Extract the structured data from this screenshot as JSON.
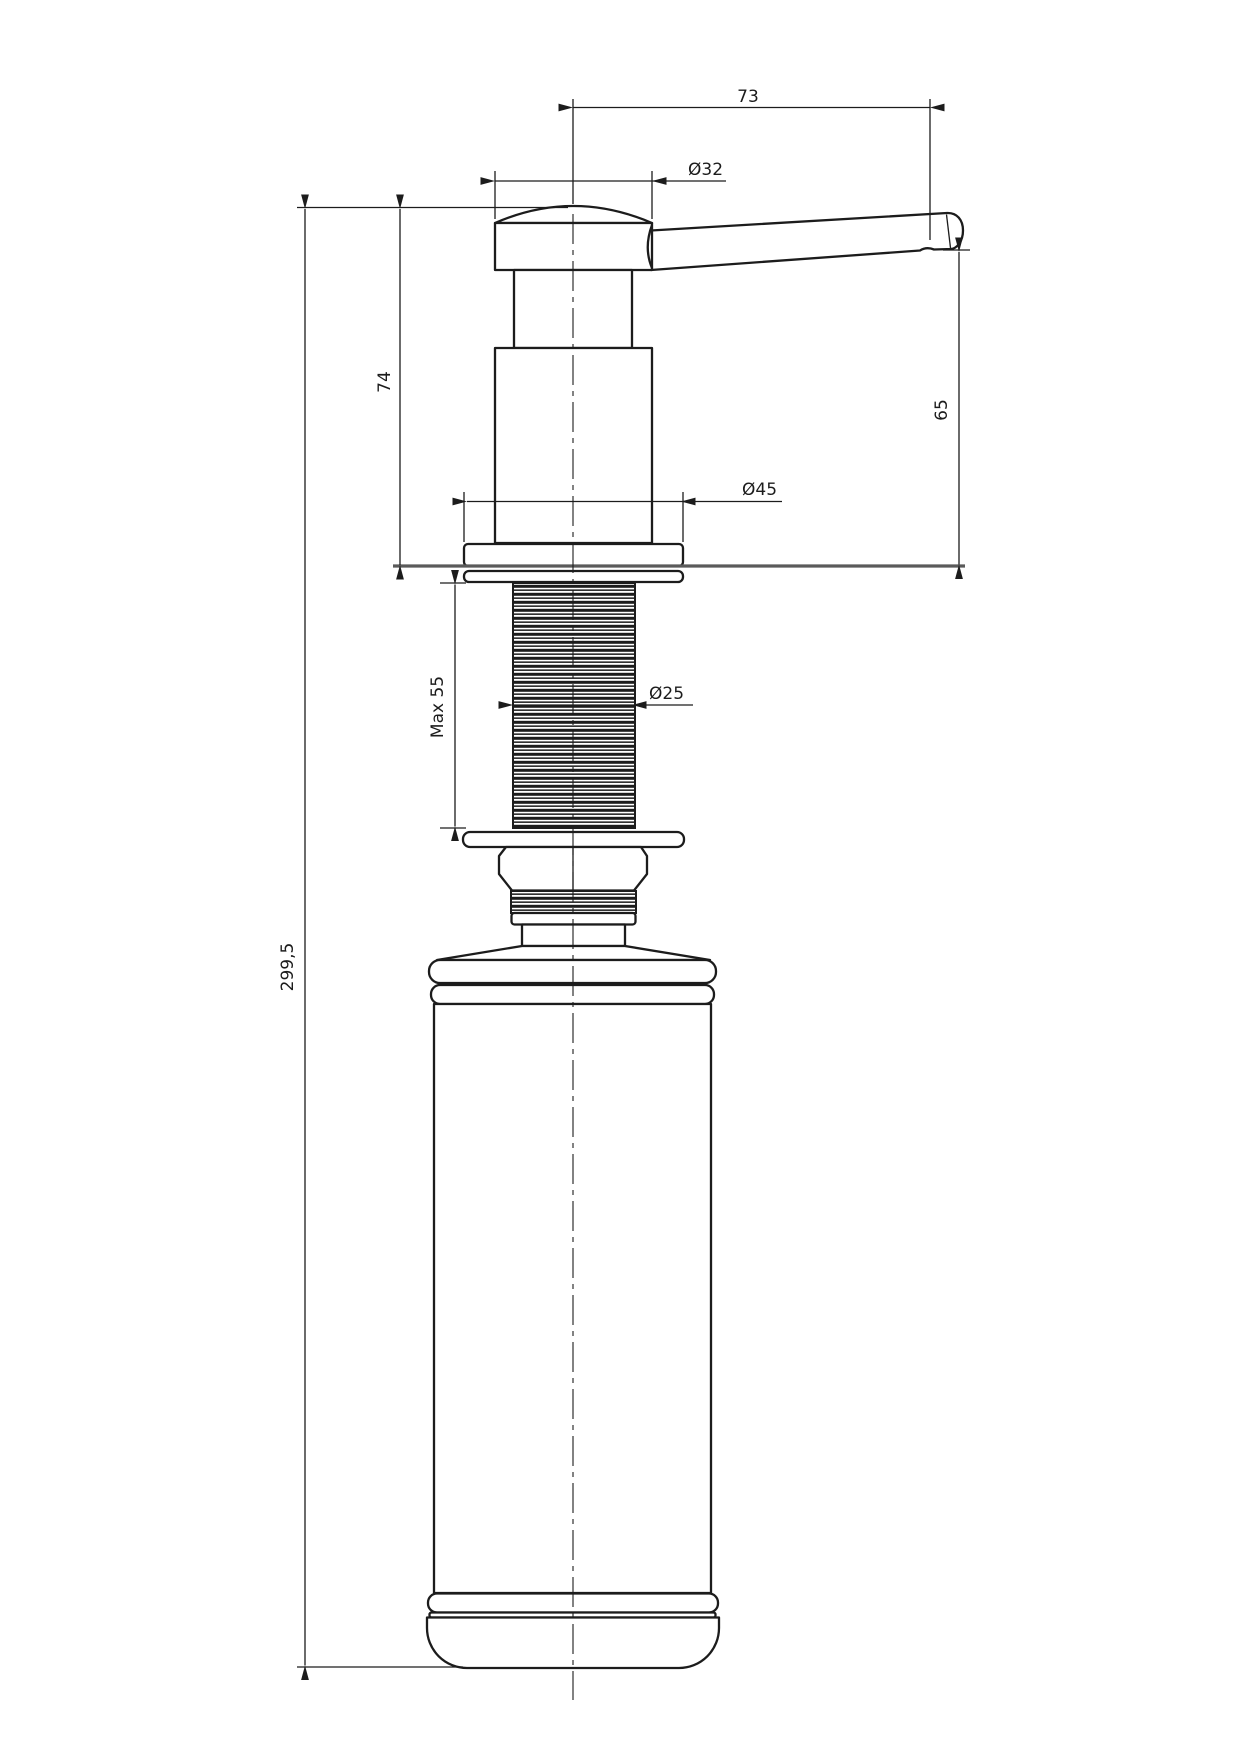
{
  "drawing": {
    "type": "technical-drawing",
    "subject": "kitchen sink soap dispenser side elevation",
    "dimensions": {
      "lever_reach": "73",
      "head_diameter": "Ø32",
      "head_height_above_counter": "74",
      "spout_height_above_counter": "65",
      "flange_diameter": "Ø45",
      "thread_diameter": "Ø25",
      "max_counter_thickness": "Max 55",
      "total_height": "299,5"
    },
    "colors": {
      "line": "#1c1c1c",
      "counter_line": "#5a5a5a",
      "background": "#ffffff"
    }
  }
}
